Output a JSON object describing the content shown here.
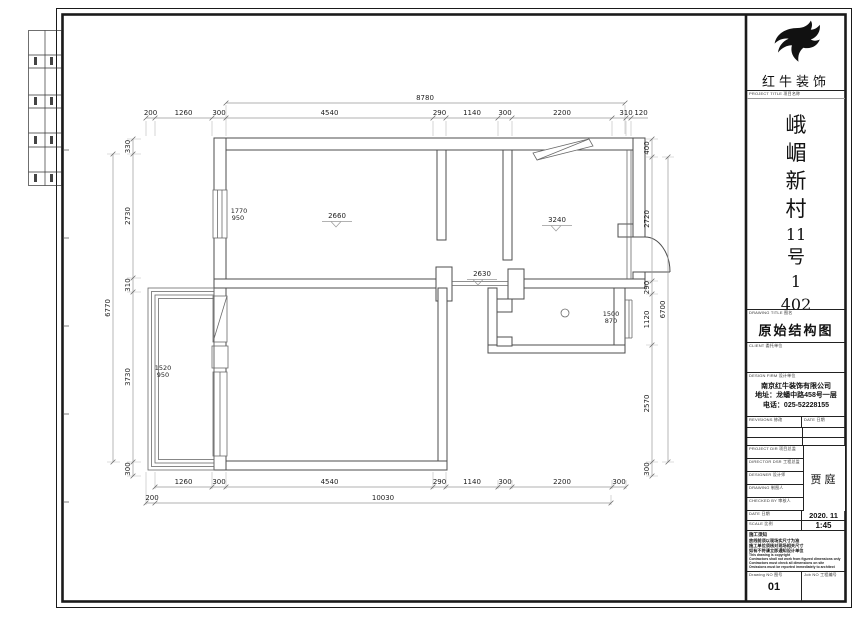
{
  "page": {
    "background": "#ffffff",
    "line_color": "#1a1a1a",
    "wall_color": "#4d4d4d",
    "dim_color": "#999999"
  },
  "brand": {
    "logo": "swallow-logo",
    "name": "红牛装饰"
  },
  "title_block": {
    "project_title_label": "PROJECT TITLE 项目名称",
    "project_title_lines": [
      "峨",
      "嵋",
      "新",
      "村",
      "11",
      "号",
      "1",
      "402"
    ],
    "drawing_title_label": "DRAWING TITLE 图名",
    "drawing_title": "原始结构图",
    "client_label": "CLIENT 委托单位",
    "design_firm_label": "DESIGN FIRM 设计单位",
    "company_name": "南京红牛装饰有限公司",
    "company_address": "地址：龙蟠中路458号一层",
    "company_phone": "电话：025-52228155",
    "revisions_label": "REVISIONS 修改",
    "revisions_date_label": "DATE 日期",
    "rows": [
      {
        "label": "PROJECT DIR 项目总监"
      },
      {
        "label": "DIRECTOR DSR 工程总监"
      },
      {
        "label": "DESIGNER 设计师"
      },
      {
        "label": "DRAWING 制图人"
      },
      {
        "label": "CHECKED BY 审核人"
      }
    ],
    "designer_name": "贾庭",
    "date_label": "DATE 日期",
    "date_value": "2020. 11",
    "scale_label": "SCALE 比例",
    "scale_value": "1:45",
    "notes": [
      "施工须知",
      "放线前须以现场实尺寸为准",
      "施工单位须核对现场相关尺寸",
      "如有不符请立即通知设计单位",
      "This drawing is copyright",
      "Contractors shall not work from figured dimensions only",
      "Contractors must check all dimensions on site",
      "Omissions must be reported immediately to architect"
    ],
    "drawing_no_label": "Drawing NO 图号",
    "drawing_no": "01",
    "job_no_label": "Job NO 工程编号"
  },
  "plan": {
    "dims_top_overall": "8780",
    "dims_top": [
      "200",
      "1260",
      "300",
      "4540",
      "290",
      "1140",
      "300",
      "2200",
      "310",
      "120"
    ],
    "dims_bottom": [
      "1260",
      "300",
      "4540",
      "290",
      "1140",
      "300",
      "2200",
      "300"
    ],
    "dims_bottom_overall": [
      "200",
      "10030"
    ],
    "dims_left": [
      "330",
      "2730",
      "310",
      "3730",
      "300"
    ],
    "dims_left_overall": "6770",
    "dims_right": [
      "400",
      "2720",
      "290",
      "1120",
      "2570",
      "300"
    ],
    "dims_right_overall": "6700",
    "annotations": {
      "window_left_w": "1770",
      "window_left_h": "950",
      "height_living": "2660",
      "height_right": "3240",
      "height_hall": "2630",
      "window_right_w": "1500",
      "window_right_h": "870",
      "window_balcony_w": "1520",
      "window_balcony_h": "950"
    }
  }
}
